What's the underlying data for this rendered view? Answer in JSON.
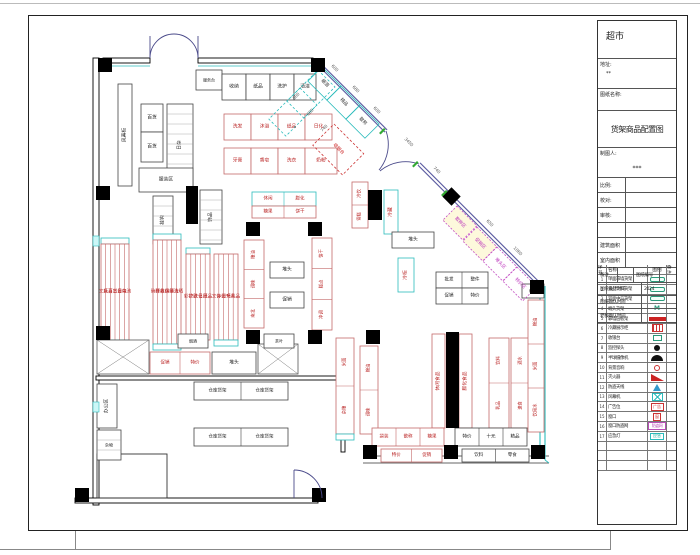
{
  "title_block": {
    "store": "超市",
    "addr_label": "地址:",
    "addr_value": "**",
    "dwg_label": "图纸名称:",
    "dwg_name": "货架商品配置图",
    "drafter_label": "制图人:",
    "drafter_value": "***",
    "info_rows": [
      {
        "l": "比例:",
        "v": ""
      },
      {
        "l": "校对:",
        "v": ""
      },
      {
        "l": "审核:",
        "v": ""
      },
      {
        "l": "",
        "v": ""
      },
      {
        "l": "建筑面积",
        "v": ""
      },
      {
        "l": "室内面积",
        "v": ""
      }
    ],
    "note_label": "备注",
    "sheet_no_label": "图纸编号",
    "time1_label": "图纸设计时间",
    "time1_value": "2024",
    "time2_label": "图纸确认时间",
    "time2_value": "",
    "time3_label": "老板确认时间",
    "time3_value": ""
  },
  "legend": {
    "headers": [
      "序号",
      "名称",
      "图例",
      "备注"
    ],
    "rows": [
      {
        "no": "1",
        "name": "单面靠墙货架",
        "sym": "pill"
      },
      {
        "no": "2",
        "name": "食品饮料货架",
        "sym": "pill"
      },
      {
        "no": "3",
        "name": "双面中岛货架",
        "sym": "pill"
      },
      {
        "no": "4",
        "name": "端头货架",
        "sym": "m",
        "symtext": "M"
      },
      {
        "no": "5",
        "name": "靠墙层板架",
        "sym": "bar"
      },
      {
        "no": "6",
        "name": "冷藏展示柜",
        "sym": "grid"
      },
      {
        "no": "7",
        "name": "收银台",
        "sym": "boxg"
      },
      {
        "no": "8",
        "name": "监控探头",
        "sym": "dot"
      },
      {
        "no": "9",
        "name": "半球摄像机",
        "sym": "dome"
      },
      {
        "no": "10",
        "name": "背景音响",
        "sym": "ring"
      },
      {
        "no": "11",
        "name": "灭火器",
        "sym": "wedge"
      },
      {
        "no": "12",
        "name": "防盗天线",
        "sym": "tri"
      },
      {
        "no": "13",
        "name": "风幕机",
        "sym": "xbox"
      },
      {
        "no": "14",
        "name": "广告位",
        "sym": "boxr",
        "symtext": "广告"
      },
      {
        "no": "15",
        "name": "窗口",
        "sym": "boxr2",
        "symtext": "窗"
      },
      {
        "no": "16",
        "name": "窗口防盗网",
        "sym": "boxm",
        "symtext": "防盗网"
      },
      {
        "no": "17",
        "name": "应急灯",
        "sym": "boxc",
        "symtext": "应急"
      },
      {
        "no": "",
        "name": "",
        "sym": ""
      },
      {
        "no": "",
        "name": "",
        "sym": ""
      },
      {
        "no": "",
        "name": "",
        "sym": ""
      }
    ]
  },
  "plan": {
    "walls": [
      {
        "x": 103,
        "y": 58,
        "w": 47,
        "h": 5
      },
      {
        "x": 198,
        "y": 58,
        "w": 115,
        "h": 5
      },
      {
        "x": 93,
        "y": 58,
        "w": 6,
        "h": 447
      },
      {
        "x": 96,
        "y": 376,
        "w": 248,
        "h": 4
      },
      {
        "x": 341,
        "y": 376,
        "w": 4,
        "h": 76
      },
      {
        "x": 75,
        "y": 498,
        "w": 243,
        "h": 5
      }
    ],
    "rooms": [
      {
        "x": 97,
        "y": 454,
        "w": 70,
        "h": 44
      }
    ],
    "lines": [
      {
        "x1": 363,
        "y1": 456,
        "x2": 549,
        "y2": 456,
        "c": "#333",
        "w": 0.8
      },
      {
        "x1": 363,
        "y1": 463,
        "x2": 549,
        "y2": 463,
        "c": "#333",
        "w": 0.8
      },
      {
        "x1": 540,
        "y1": 286,
        "x2": 540,
        "y2": 456,
        "c": "#2bbcbc",
        "w": 1.1
      },
      {
        "x1": 545,
        "y1": 286,
        "x2": 545,
        "y2": 460,
        "c": "#2bbcbc",
        "w": 1.1
      },
      {
        "x1": 103,
        "y1": 66,
        "x2": 150,
        "y2": 66,
        "c": "#2bbcbc",
        "w": 0.8
      },
      {
        "x1": 198,
        "y1": 66,
        "x2": 313,
        "y2": 66,
        "c": "#2bbcbc",
        "w": 0.8
      },
      {
        "x1": 545,
        "y1": 460,
        "x2": 549,
        "y2": 463,
        "c": "#2bbcbc",
        "w": 0.8
      }
    ],
    "diag_wall": {
      "x1": 318,
      "y1": 63,
      "x2": 541,
      "y2": 286,
      "gap_x1": 386,
      "gap_y1": 131,
      "gap_x2": 419,
      "gap_y2": 164,
      "color": "#5a5aa0"
    },
    "columns": [
      [
        98,
        58
      ],
      [
        311,
        58
      ],
      [
        96,
        186
      ],
      [
        96,
        326
      ],
      [
        246,
        330
      ],
      [
        308,
        330
      ],
      [
        366,
        330
      ],
      [
        246,
        222
      ],
      [
        308,
        222
      ],
      [
        530,
        280
      ],
      [
        75,
        488
      ],
      [
        312,
        488
      ],
      [
        363,
        445
      ],
      [
        444,
        445
      ],
      [
        531,
        445
      ]
    ],
    "bars": [
      [
        186,
        186,
        12,
        38
      ],
      [
        368,
        190,
        14,
        30
      ],
      [
        446,
        332,
        13,
        96
      ]
    ],
    "diamond": {
      "x": 445,
      "y": 190,
      "s": 13
    },
    "cyan_marks": [
      [
        93,
        236,
        6,
        10
      ],
      [
        93,
        402,
        6,
        10
      ]
    ],
    "shelves": [
      {
        "x": 196,
        "y": 70,
        "w": 26,
        "h": 20,
        "s": "k",
        "t": "服务台",
        "fs": 4
      },
      {
        "x": 222,
        "y": 74,
        "w": 24,
        "h": 26,
        "s": "k",
        "t": "收纳"
      },
      {
        "x": 246,
        "y": 74,
        "w": 24,
        "h": 26,
        "s": "k",
        "t": "纸品"
      },
      {
        "x": 270,
        "y": 74,
        "w": 24,
        "h": 26,
        "s": "k",
        "t": "洗护"
      },
      {
        "x": 294,
        "y": 74,
        "w": 22,
        "h": 26,
        "s": "k",
        "t": "清洁"
      },
      {
        "x": 118,
        "y": 84,
        "w": 14,
        "h": 102,
        "s": "k",
        "t": "风幕柜",
        "v": 1
      },
      {
        "x": 141,
        "y": 104,
        "w": 22,
        "h": 28,
        "s": "k",
        "t": "百货"
      },
      {
        "x": 141,
        "y": 132,
        "w": 22,
        "h": 30,
        "s": "k",
        "t": "百货"
      },
      {
        "x": 167,
        "y": 104,
        "w": 26,
        "h": 82,
        "s": "k",
        "t": "日杂",
        "v": 1,
        "grid": 1
      },
      {
        "x": 139,
        "y": 168,
        "w": 54,
        "h": 24,
        "s": "k",
        "t": "服装区"
      },
      {
        "x": 153,
        "y": 196,
        "w": 20,
        "h": 48,
        "s": "k",
        "t": "挂钩",
        "v": 1,
        "grid": 1
      },
      {
        "x": 200,
        "y": 190,
        "w": 22,
        "h": 54,
        "s": "k",
        "t": "饰品",
        "v": 1,
        "grid": 1
      },
      {
        "x": 224,
        "y": 114,
        "w": 27,
        "h": 26,
        "s": "r",
        "t": "洗发"
      },
      {
        "x": 251,
        "y": 114,
        "w": 27,
        "h": 26,
        "s": "r",
        "t": "沐浴"
      },
      {
        "x": 278,
        "y": 114,
        "w": 27,
        "h": 26,
        "s": "r",
        "t": "纸品"
      },
      {
        "x": 305,
        "y": 114,
        "w": 27,
        "h": 26,
        "s": "r",
        "t": "日化"
      },
      {
        "x": 224,
        "y": 148,
        "w": 27,
        "h": 26,
        "s": "r",
        "t": "牙膏"
      },
      {
        "x": 251,
        "y": 148,
        "w": 27,
        "h": 26,
        "s": "r",
        "t": "香皂"
      },
      {
        "x": 278,
        "y": 148,
        "w": 27,
        "h": 26,
        "s": "r",
        "t": "洗衣"
      },
      {
        "x": 305,
        "y": 148,
        "w": 32,
        "h": 26,
        "s": "r",
        "t": "奶粉"
      },
      {
        "x": 101,
        "y": 238,
        "w": 28,
        "h": 6,
        "s": "c"
      },
      {
        "x": 101,
        "y": 244,
        "w": 28,
        "h": 96,
        "s": "r",
        "cells": [
          "文具",
          "玩具",
          "百货",
          "五金",
          "日杂",
          "电池"
        ]
      },
      {
        "x": 101,
        "y": 340,
        "w": 28,
        "h": 6,
        "s": "c"
      },
      {
        "x": 153,
        "y": 234,
        "w": 28,
        "h": 6,
        "s": "c"
      },
      {
        "x": 153,
        "y": 240,
        "w": 28,
        "h": 104,
        "s": "r",
        "cells": [
          "碗碟",
          "杯具",
          "收纳",
          "保鲜",
          "清洁",
          "洗晒"
        ]
      },
      {
        "x": 153,
        "y": 344,
        "w": 28,
        "h": 6,
        "s": "c"
      },
      {
        "x": 186,
        "y": 248,
        "w": 24,
        "h": 6,
        "s": "c"
      },
      {
        "x": 186,
        "y": 254,
        "w": 24,
        "h": 86,
        "s": "r",
        "cells": [
          "彩妆",
          "护肤",
          "洗化",
          "日用",
          "纸品"
        ]
      },
      {
        "x": 214,
        "y": 254,
        "w": 24,
        "h": 86,
        "s": "r",
        "cells": [
          "文体",
          "办公",
          "图书",
          "玩具",
          "礼品"
        ]
      },
      {
        "x": 214,
        "y": 340,
        "w": 24,
        "h": 6,
        "s": "c"
      },
      {
        "x": 252,
        "y": 192,
        "w": 64,
        "h": 14,
        "s": "c",
        "cells": [
          "休闲",
          "膨化"
        ]
      },
      {
        "x": 252,
        "y": 206,
        "w": 64,
        "h": 12,
        "s": "r",
        "cells": [
          "糖果",
          "饼干"
        ]
      },
      {
        "x": 244,
        "y": 240,
        "w": 20,
        "h": 88,
        "s": "r",
        "cellsV": [
          "粮油",
          "调味",
          "南北"
        ]
      },
      {
        "x": 312,
        "y": 238,
        "w": 20,
        "h": 92,
        "s": "r",
        "cellsV": [
          "饼干",
          "糕点",
          "冲调"
        ]
      },
      {
        "x": 270,
        "y": 262,
        "w": 34,
        "h": 16,
        "s": "k",
        "t": "堆头"
      },
      {
        "x": 270,
        "y": 292,
        "w": 34,
        "h": 16,
        "s": "k",
        "t": "促销"
      },
      {
        "x": 352,
        "y": 182,
        "w": 16,
        "h": 46,
        "s": "r",
        "cellsV": [
          "冷饮",
          "雪糕"
        ]
      },
      {
        "x": 384,
        "y": 190,
        "w": 14,
        "h": 44,
        "s": "c",
        "t": "冷藏",
        "v": 1
      },
      {
        "x": 392,
        "y": 232,
        "w": 42,
        "h": 16,
        "s": "k",
        "t": "堆头"
      },
      {
        "x": 436,
        "y": 272,
        "w": 52,
        "h": 16,
        "s": "k",
        "cells": [
          "批发",
          "整件"
        ]
      },
      {
        "x": 436,
        "y": 288,
        "w": 52,
        "h": 16,
        "s": "k",
        "cells": [
          "促销",
          "特价"
        ]
      },
      {
        "x": 398,
        "y": 258,
        "w": 16,
        "h": 34,
        "s": "c",
        "t": "冷柜",
        "v": 1
      },
      {
        "x": 336,
        "y": 338,
        "w": 18,
        "h": 96,
        "s": "r",
        "cellsV": [
          "米面",
          "杂粮"
        ]
      },
      {
        "x": 336,
        "y": 434,
        "w": 18,
        "h": 6,
        "s": "c"
      },
      {
        "x": 360,
        "y": 346,
        "w": 18,
        "h": 88,
        "s": "r",
        "cellsV": [
          "粮油",
          "调味"
        ]
      },
      {
        "x": 432,
        "y": 334,
        "w": 13,
        "h": 94,
        "s": "r",
        "t": "休闲食品",
        "v": 1
      },
      {
        "x": 459,
        "y": 334,
        "w": 13,
        "h": 94,
        "s": "r",
        "t": "膨化食品",
        "v": 1
      },
      {
        "x": 489,
        "y": 338,
        "w": 20,
        "h": 90,
        "s": "r",
        "cellsV": [
          "饮料",
          "乳品"
        ]
      },
      {
        "x": 511,
        "y": 338,
        "w": 20,
        "h": 90,
        "s": "r",
        "cellsV": [
          "酒水",
          "速食"
        ]
      },
      {
        "x": 528,
        "y": 300,
        "w": 16,
        "h": 132,
        "s": "r",
        "cellsV": [
          "粮油",
          "米面",
          "饮用水"
        ]
      },
      {
        "x": 522,
        "y": 284,
        "w": 22,
        "h": 14,
        "s": "k",
        "t": "堆头",
        "fs": 4
      },
      {
        "x": 372,
        "y": 428,
        "w": 72,
        "h": 18,
        "s": "r",
        "cells": [
          "袋装",
          "散称",
          "糖果"
        ]
      },
      {
        "x": 455,
        "y": 428,
        "w": 72,
        "h": 18,
        "s": "k",
        "cells": [
          "特价",
          "十元",
          "精品"
        ]
      },
      {
        "x": 381,
        "y": 449,
        "w": 61,
        "h": 13,
        "s": "r",
        "cells": [
          "特价",
          "促销"
        ]
      },
      {
        "x": 462,
        "y": 449,
        "w": 67,
        "h": 13,
        "s": "k",
        "cells": [
          "饮料",
          "零食"
        ]
      },
      {
        "x": 97,
        "y": 340,
        "w": 52,
        "h": 34,
        "s": "hatch"
      },
      {
        "x": 150,
        "y": 352,
        "w": 60,
        "h": 22,
        "s": "r",
        "cells": [
          "促销",
          "特价"
        ]
      },
      {
        "x": 212,
        "y": 352,
        "w": 44,
        "h": 22,
        "s": "k",
        "t": "堆头"
      },
      {
        "x": 258,
        "y": 344,
        "w": 40,
        "h": 30,
        "s": "hatch"
      },
      {
        "x": 178,
        "y": 334,
        "w": 30,
        "h": 14,
        "s": "k",
        "t": "烟酒",
        "fs": 4
      },
      {
        "x": 264,
        "y": 334,
        "w": 30,
        "h": 14,
        "s": "k",
        "t": "茶叶",
        "fs": 4
      },
      {
        "x": 194,
        "y": 382,
        "w": 94,
        "h": 18,
        "s": "k",
        "cells": [
          "仓库货架",
          "仓库货架"
        ]
      },
      {
        "x": 194,
        "y": 428,
        "w": 94,
        "h": 18,
        "s": "k",
        "cells": [
          "仓库货架",
          "仓库货架"
        ]
      },
      {
        "x": 97,
        "y": 384,
        "w": 20,
        "h": 44,
        "s": "k",
        "t": "办公区",
        "v": 1
      },
      {
        "x": 97,
        "y": 430,
        "w": 24,
        "h": 30,
        "s": "k",
        "t": "杂物",
        "grid": 1,
        "fs": 4
      }
    ],
    "rot_shelves": [
      {
        "x": 322,
        "y": 67,
        "w": 27,
        "h": 20,
        "s": "c2",
        "t": "烟酒"
      },
      {
        "x": 341,
        "y": 86,
        "w": 27,
        "h": 20,
        "s": "c2",
        "t": "精品"
      },
      {
        "x": 360,
        "y": 105,
        "w": 27,
        "h": 20,
        "s": "c2",
        "t": "散称"
      },
      {
        "x": 300,
        "y": 88,
        "w": 24,
        "h": 44,
        "s": "cd",
        "t": ""
      },
      {
        "x": 318,
        "y": 70,
        "w": 24,
        "h": 44,
        "s": "cd",
        "t": ""
      },
      {
        "x": 334,
        "y": 124,
        "w": 42,
        "h": 30,
        "s": "rd",
        "t": "收银台"
      },
      {
        "x": 457,
        "y": 206,
        "w": 28,
        "h": 20,
        "s": "m",
        "t": "散称区",
        "f": "#fdf8dc"
      },
      {
        "x": 477,
        "y": 227,
        "w": 28,
        "h": 20,
        "s": "m",
        "t": "促销区",
        "f": "#fdf8dc"
      },
      {
        "x": 497,
        "y": 247,
        "w": 28,
        "h": 20,
        "s": "m",
        "t": "堆头区"
      },
      {
        "x": 517,
        "y": 267,
        "w": 28,
        "h": 20,
        "s": "m",
        "t": "特价区"
      }
    ],
    "arcs": [
      "M150,58 A24 24 0 0 1 174,34",
      "M198,58 A24 24 0 0 0 174,34",
      "M150,58 L150,36",
      "M198,58 L198,36",
      "M386,131 A40 40 0 0 1 379,170",
      "M419,164 A40 40 0 0 0 380,171",
      "M294,470 L294,498",
      "M294,470 A28 28 0 0 1 322,498"
    ],
    "ticks": [
      [
        384,
        128
      ],
      [
        417,
        161
      ],
      [
        446,
        190
      ]
    ],
    "dims": [
      {
        "x": 335,
        "y": 68,
        "t": "600",
        "r": 45
      },
      {
        "x": 356,
        "y": 89,
        "t": "680",
        "r": 45
      },
      {
        "x": 377,
        "y": 110,
        "t": "600",
        "r": 45
      },
      {
        "x": 409,
        "y": 142,
        "t": "3450",
        "r": 45
      },
      {
        "x": 437,
        "y": 170,
        "t": "740",
        "r": 45
      },
      {
        "x": 490,
        "y": 223,
        "t": "650",
        "r": 45
      },
      {
        "x": 518,
        "y": 251,
        "t": "1060",
        "r": 45
      },
      {
        "x": 296,
        "y": 96,
        "t": "600",
        "r": -45
      },
      {
        "x": 310,
        "y": 112,
        "t": "600",
        "r": -45
      },
      {
        "x": 324,
        "y": 128,
        "t": "740",
        "r": -45
      }
    ]
  }
}
